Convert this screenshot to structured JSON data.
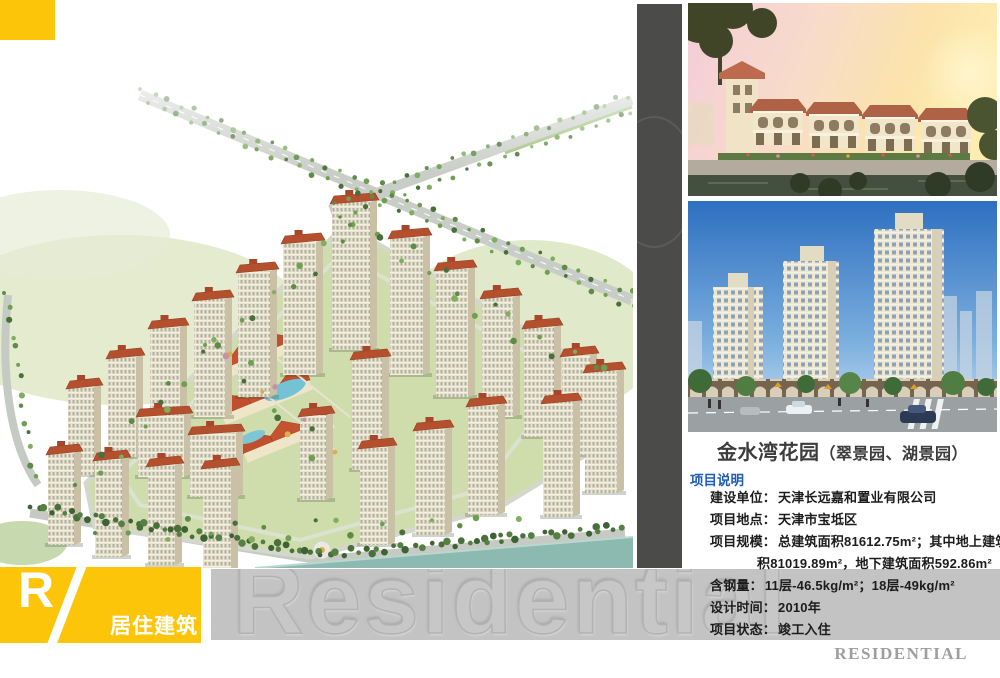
{
  "category": {
    "letter": "R",
    "label": "居住建筑"
  },
  "footer": {
    "brand": "RESIDENTIAL",
    "watermark": "Residential"
  },
  "project": {
    "title_main": "金水湾花园",
    "title_paren": "（翠景园、湖景园）",
    "section_label": "项目说明",
    "details": [
      {
        "label": "建设单位：",
        "text": "天津长远嘉和置业有限公司"
      },
      {
        "label": "项目地点：",
        "text": "天津市宝坻区"
      },
      {
        "label": "项目规模：",
        "text": "总建筑面积81612.75m²；其中地上建筑面",
        "text2": "积81019.89m²，地下建筑面积592.86m²"
      },
      {
        "label": "含钢量：",
        "text": "11层-46.5kg/m²；18层-49kg/m²"
      },
      {
        "label": "设计时间：",
        "text": "2010年"
      },
      {
        "label": "项目状态：",
        "text": "竣工入住"
      }
    ]
  },
  "colors": {
    "accent_yellow": "#fcc50a",
    "section_label_blue": "#1f5cb5",
    "watermark_band_gray": "#c3c3c3",
    "divider_strip_gray": "#4b4b49"
  }
}
